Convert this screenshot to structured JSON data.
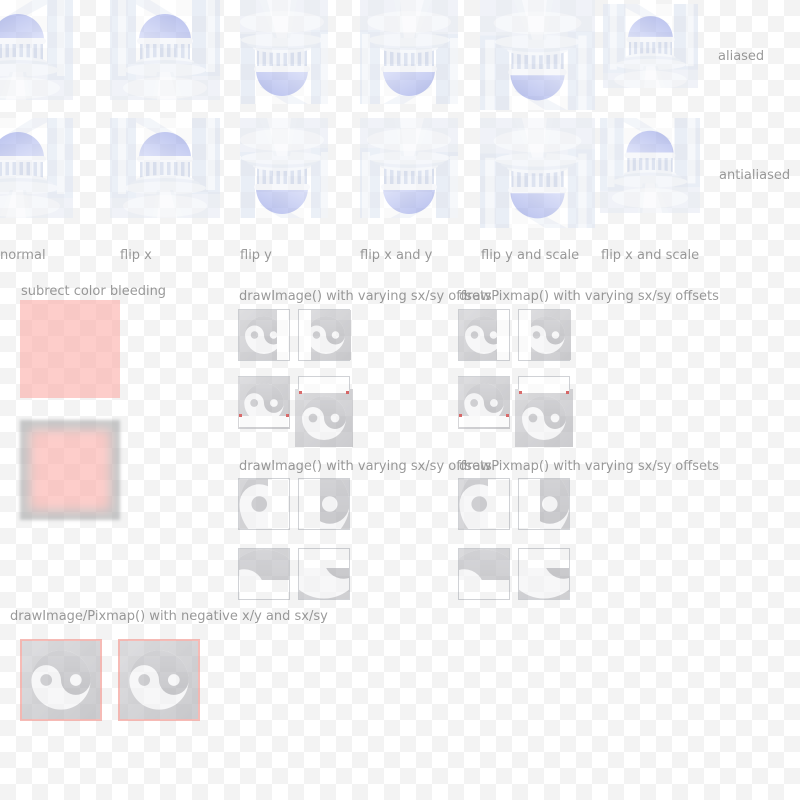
{
  "render_labels": {
    "row1": "aliased",
    "row2": "antialiased"
  },
  "transform_labels": [
    "normal",
    "flip x",
    "flip y",
    "flip x and y",
    "flip y and scale",
    "flip x and scale"
  ],
  "section_titles": {
    "subrect": "subrect color bleeding",
    "draw_image_offsets_1": "drawImage() with varying sx/sy offsets",
    "draw_pixmap_offsets_1": "drawPixmap() with varying sx/sy offsets",
    "draw_image_offsets_2": "drawImage() with varying sx/sy offsets",
    "draw_pixmap_offsets_2": "drawPixmap() with varying sx/sy offsets",
    "negative": "drawImage/Pixmap() with negative x/y and sx/sy"
  },
  "colors": {
    "checker_gray": "#f3f3f3",
    "label_gray": "#a4a2a2",
    "pink_fill": "#fdcfcc",
    "pink_border": "#f8c0bc",
    "frame_gray": "#cacccd",
    "red_dot": "#d42020",
    "dome_lavender": "#c3c9f1",
    "yinyang_bg": "#d6d6d9",
    "yinyang_dark": "#cfcfd3",
    "yinyang_light": "#fafafa"
  }
}
